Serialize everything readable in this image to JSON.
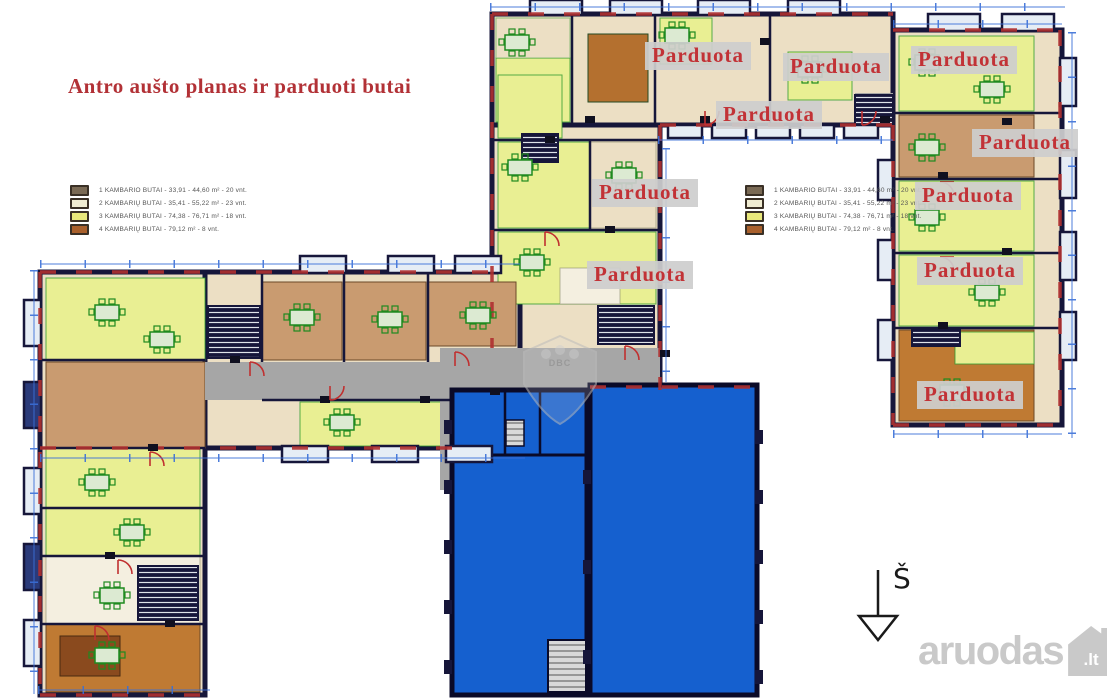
{
  "title": {
    "text": "Antro aušto planas ir parduoti butai",
    "color": "#b23136"
  },
  "labels": {
    "sold": "Parduota"
  },
  "legend": {
    "items": [
      {
        "color": "#7a6a55",
        "label": "1 KAMBARIO BUTAI - 33,91 - 44,60 m² - 20 vnt."
      },
      {
        "color": "#f0ecd2",
        "label": "2 KAMBARIŲ BUTAI - 35,41 - 55,22 m² - 23 vnt."
      },
      {
        "color": "#e9e87b",
        "label": "3 KAMBARIŲ BUTAI - 74,38 - 76,71 m² - 18 vnt."
      },
      {
        "color": "#a9602c",
        "label": "4 KAMBARIŲ BUTAI - 79,12 m² - 8 vnt."
      }
    ]
  },
  "compass": {
    "label": "Š",
    "direction": "south"
  },
  "watermark": {
    "brand": "aruodas",
    "tld": ".lt"
  },
  "center_watermark": {
    "text": "DBC"
  },
  "colors": {
    "title": "#b23136",
    "sold_text": "#c23236",
    "sold_background": "#cecece",
    "walls": "#16163a",
    "commercial_blue": "#1560cf",
    "apartment_yellow": "#e9ef93",
    "apartment_cream": "#ecdfc4",
    "apartment_tan": "#c99b70",
    "apartment_brown": "#b4702f",
    "corridor_gray": "#a6a6a6",
    "dimension_blue": "#3a6fd8",
    "furniture_green": "#1f8a1f",
    "door_red": "#c03030"
  }
}
